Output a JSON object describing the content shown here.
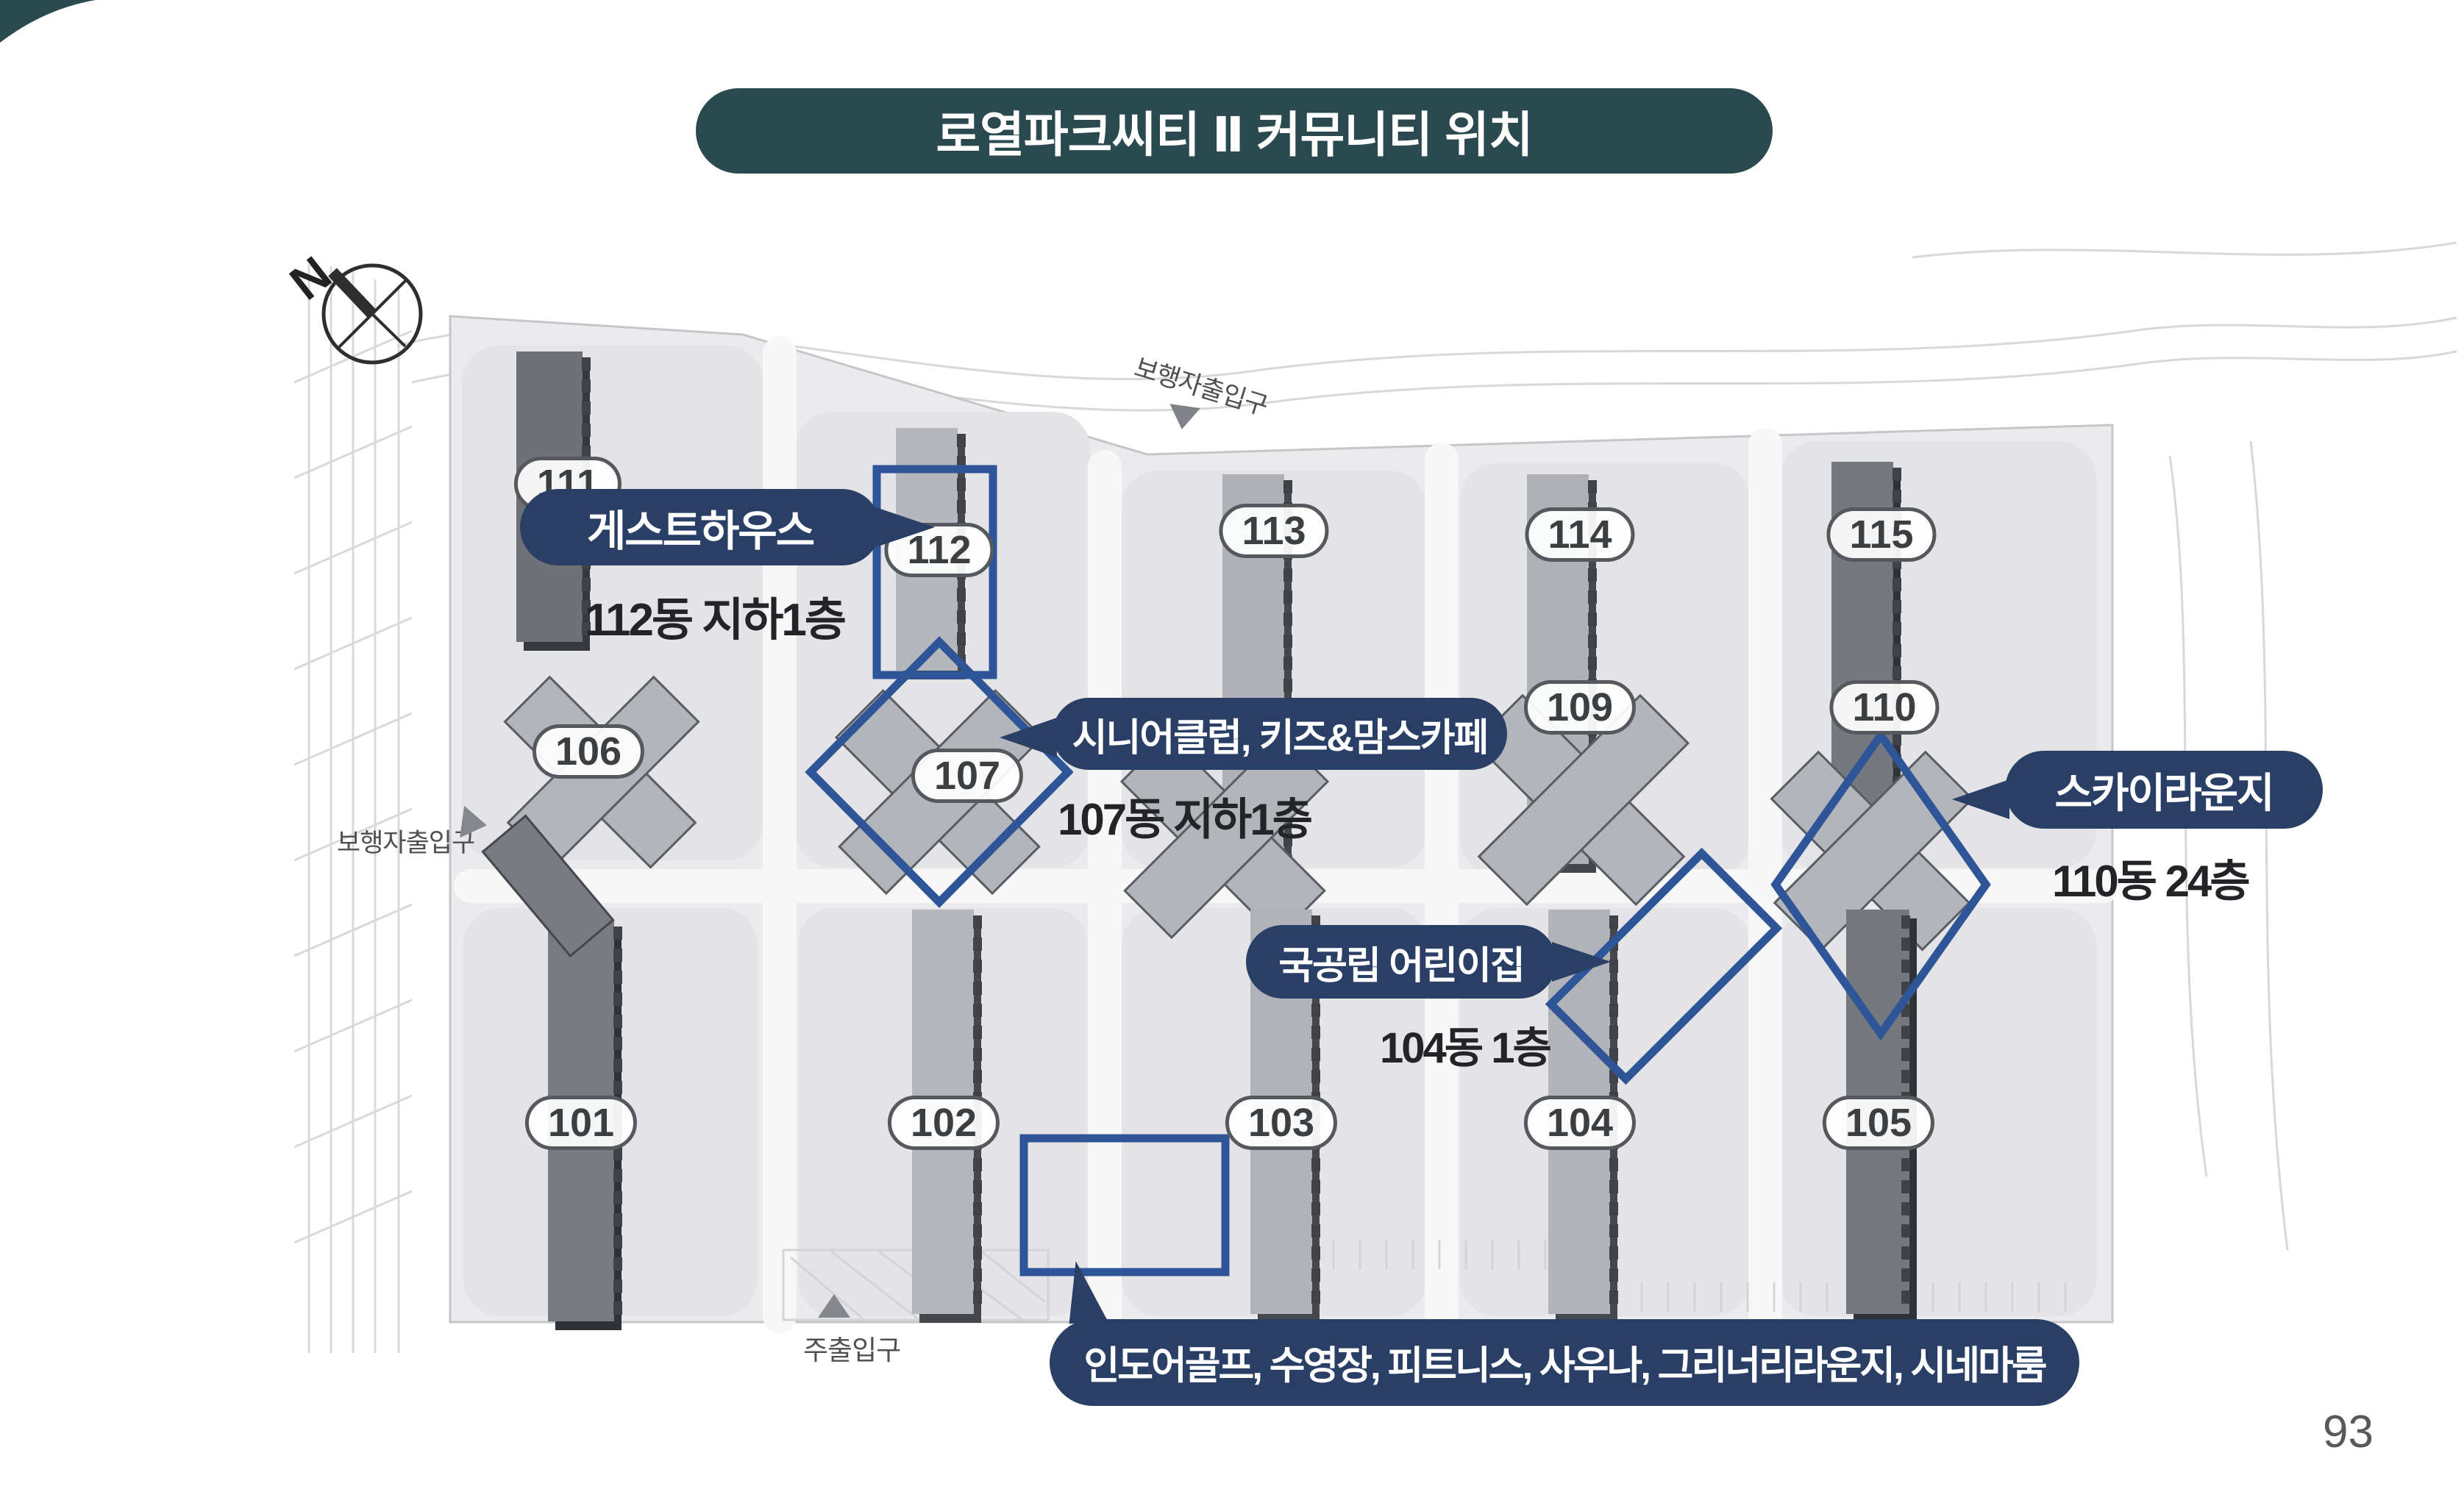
{
  "slide": {
    "title": "로열파크씨티 Ⅱ 커뮤니티 위치",
    "page_number": "93"
  },
  "compass": {
    "north_label": "N"
  },
  "entrances": {
    "top_pedestrian": "보행자출입구",
    "left_pedestrian": "보행자출입구",
    "main_bottom": "주출입구"
  },
  "buildings": [
    {
      "label": "101"
    },
    {
      "label": "102"
    },
    {
      "label": "103"
    },
    {
      "label": "104"
    },
    {
      "label": "105"
    },
    {
      "label": "106"
    },
    {
      "label": "107"
    },
    {
      "label": "109"
    },
    {
      "label": "110"
    },
    {
      "label": "111"
    },
    {
      "label": "112"
    },
    {
      "label": "113"
    },
    {
      "label": "114"
    },
    {
      "label": "115"
    }
  ],
  "callouts": {
    "guesthouse": {
      "name": "게스트하우스",
      "location": "112동 지하1층"
    },
    "senior_kids_cafe": {
      "name": "시니어클럽, 키즈&맘스카페",
      "location": "107동 지하1층"
    },
    "sky_lounge": {
      "name": "스카이라운지",
      "location": "110동 24층"
    },
    "daycare": {
      "name": "국공립 어린이집",
      "location": "104동 1층"
    },
    "clubhouse": {
      "name": "인도어골프, 수영장, 피트니스, 사우나, 그리너리라운지, 시네마룸"
    }
  },
  "colors": {
    "title_teal": "#2b4a50",
    "callout_navy": "#2a3f66",
    "highlight_blue": "#2e5597"
  }
}
